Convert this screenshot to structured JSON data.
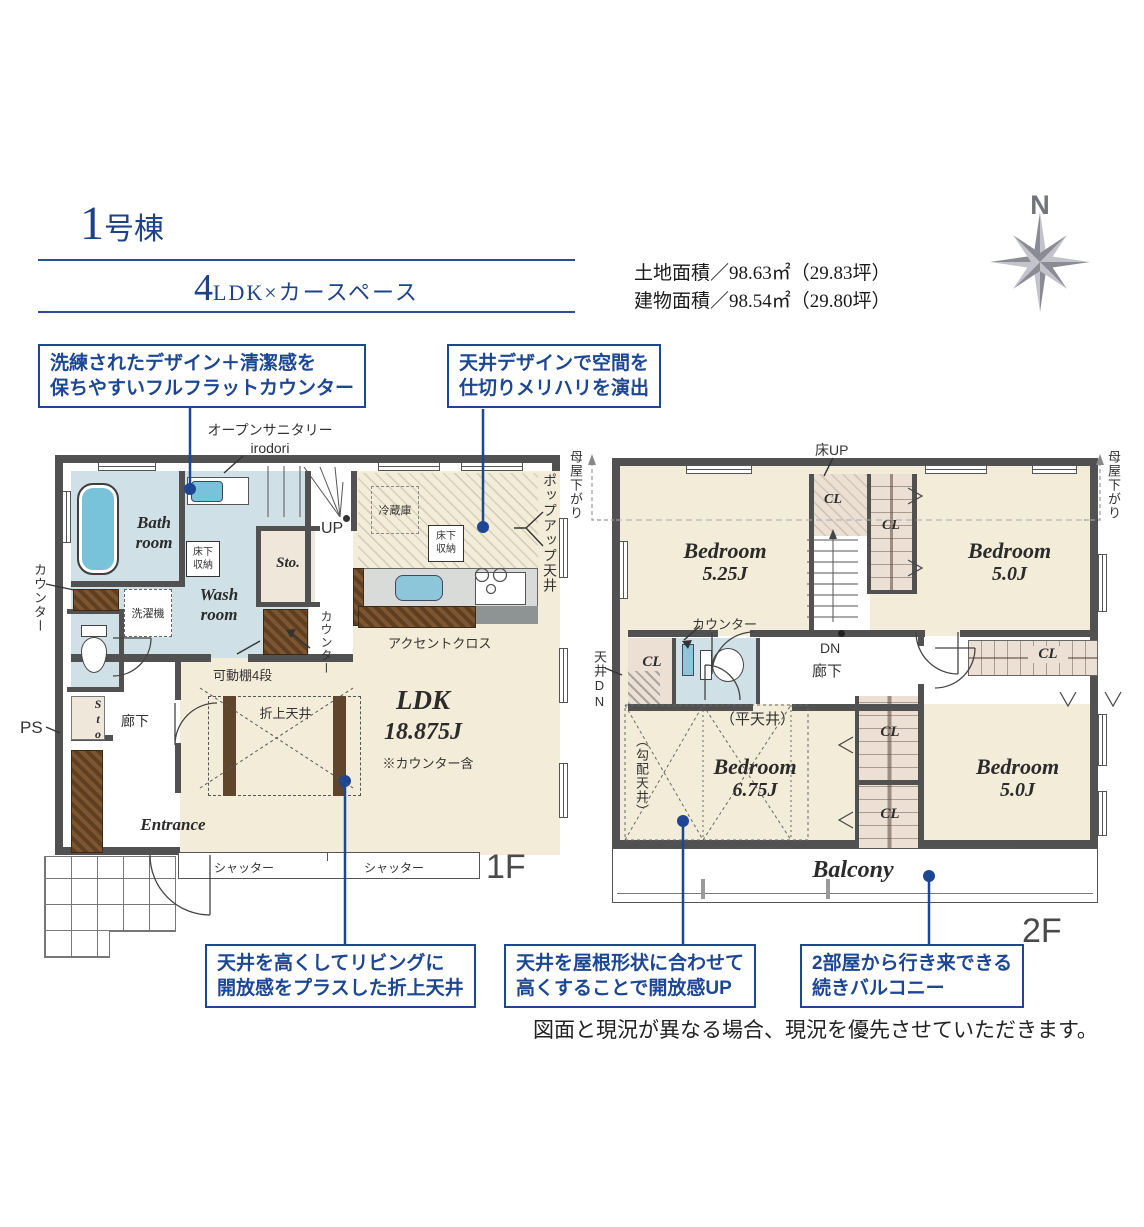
{
  "header": {
    "title_num": "1",
    "title_suffix": "号棟",
    "subtitle_num": "4",
    "subtitle_text": "LDK×カースペース",
    "land_area": "土地面積／98.63㎡（29.83坪）",
    "building_area": "建物面積／98.54㎡（29.80坪）",
    "compass_n": "N"
  },
  "callouts": {
    "flat_counter": {
      "line1": "洗練されたデザイン＋清潔感を",
      "line2": "保ちやすいフルフラットカウンター"
    },
    "ceiling_design": {
      "line1": "天井デザインで空間を",
      "line2": "仕切りメリハリを演出"
    },
    "coffered": {
      "line1": "天井を高くしてリビングに",
      "line2": "開放感をプラスした折上天井"
    },
    "sloped": {
      "line1": "天井を屋根形状に合わせて",
      "line2": "高くすることで開放感UP"
    },
    "balcony": {
      "line1": "2部屋から行き来できる",
      "line2": "続きバルコニー"
    }
  },
  "floor1": {
    "floor_label": "1F",
    "open_sanitary_line1": "オープンサニタリー",
    "open_sanitary_line2": "irodori",
    "bath_line1": "Bath",
    "bath_line2": "room",
    "wash_line1": "Wash",
    "wash_line2": "room",
    "washer": "洗濯機",
    "storage_wash": "床下収納",
    "storage_kitchen": "床下収納",
    "fridge": "冷蔵庫",
    "sto_upper": "Sto.",
    "sto_hall": "Sto.",
    "up": "UP",
    "counter_left": "カウンター",
    "counter_mid": "カウンター",
    "shelf": "可動棚4段",
    "accent": "アクセントクロス",
    "popup": "ポップアップ天井",
    "oriage": "折上天井",
    "ldk": "LDK",
    "ldk_size": "18.875J",
    "ldk_note": "※カウンター含",
    "hall": "廊下",
    "ps": "PS",
    "entrance": "Entrance",
    "shutter1": "シャッター",
    "shutter2": "シャッター"
  },
  "floor2": {
    "floor_label": "2F",
    "floor_up": "床UP",
    "moya_left": "母屋下がり",
    "moya_right": "母屋下がり",
    "bed1": "Bedroom",
    "bed1_size": "5.25J",
    "bed2": "Bedroom",
    "bed2_size": "5.0J",
    "bed3": "Bedroom",
    "bed3_size": "6.75J",
    "bed4": "Bedroom",
    "bed4_size": "5.0J",
    "cls": [
      "CL",
      "CL",
      "CL",
      "CL",
      "CL",
      "CL"
    ],
    "dn": "DN",
    "hall": "廊下",
    "counter": "カウンター",
    "flat_ceiling": "（平天井）",
    "slope_ceiling": "（勾配天井）",
    "ceiling_dn": "天井DN",
    "balcony": "Balcony"
  },
  "footer": {
    "disclaimer": "図面と現況が異なる場合、現況を優先させていただきます。"
  },
  "colors": {
    "accent_blue": "#1d4693",
    "wall": "#515151",
    "room_cream": "#f3ecd8",
    "wet_blue": "#cfe0e6",
    "fixture_blue": "#7cc5db",
    "closet_beige": "#ece0d5",
    "wood_brown": "#6b4a2b",
    "compass_gray": "#9a9aa2"
  }
}
